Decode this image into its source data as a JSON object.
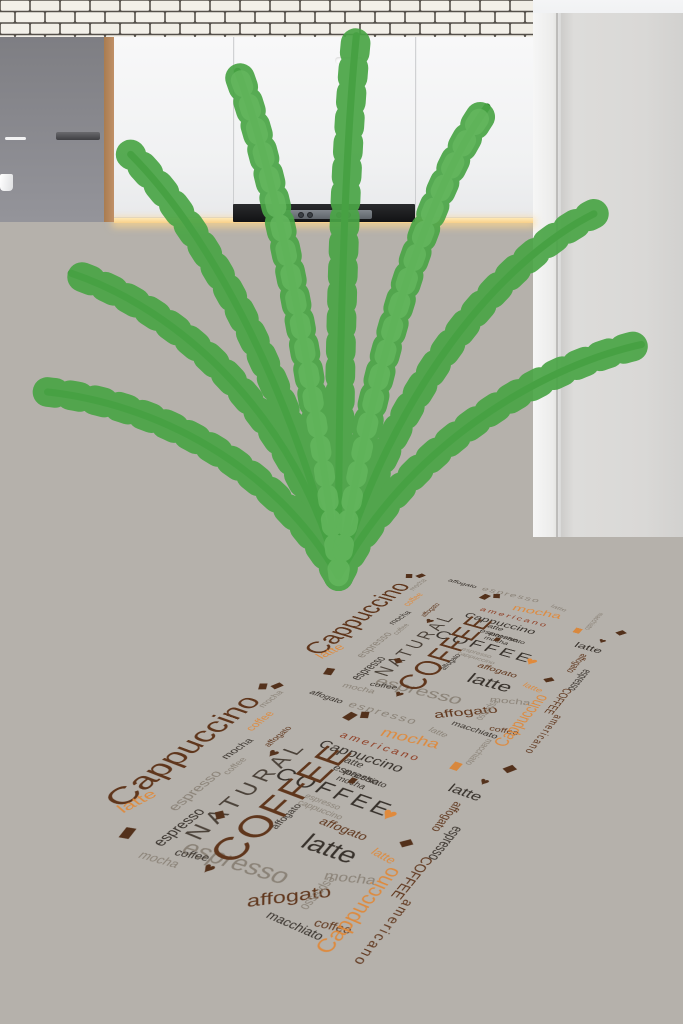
{
  "scene": {
    "palette": {
      "wall": "#e9ebee",
      "right_wall": "#d9d8d6",
      "cabinet": "#f0f1f2",
      "shelf_wood": "#bf8f66",
      "island_wood": "#7e5639",
      "tile": "#f3f0e9",
      "grout": "#4f4a45",
      "counter_marble": "#f1eee7",
      "oven_body": "#3c404a",
      "floor": "#b6b2ac",
      "under_cabinet_glow": "#ffd998",
      "plant_green": "#4aa546"
    }
  },
  "rug": {
    "width": 320,
    "height": 580,
    "tile_height": 290,
    "repeats": 2,
    "background": "#ebe4d6",
    "border_color": "#3a2313",
    "colors": {
      "brown": "#5f361c",
      "dark": "#37312b",
      "dark2": "#4a4138",
      "orange": "#dd8a3e",
      "maroon": "#8f3c22",
      "gray": "#8a8277",
      "bean": "#53311b",
      "bean_orange": "#d8883e",
      "heart_brown": "#54321c",
      "heart_orange": "#e08a3c"
    },
    "words": [
      {
        "t": "espresso",
        "x": 150,
        "y": 14,
        "s": 15,
        "r": -4,
        "c": "gray",
        "f": "serif caps outline",
        "ls": 2
      },
      {
        "t": "affogato",
        "x": 84,
        "y": 18,
        "s": 11,
        "r": 0,
        "c": "dark",
        "f": "sans bold"
      },
      {
        "t": "latte",
        "x": 215,
        "y": 16,
        "s": 11,
        "r": 6,
        "c": "gray",
        "f": "serif"
      },
      {
        "t": "macchiato",
        "x": 264,
        "y": 24,
        "s": 10,
        "r": 90,
        "c": "gray",
        "f": "sans"
      },
      {
        "t": "mocha",
        "x": 196,
        "y": 38,
        "s": 20,
        "r": -8,
        "c": "orange",
        "f": "script"
      },
      {
        "t": "americano",
        "x": 178,
        "y": 62,
        "s": 13,
        "r": -2,
        "c": "maroon",
        "f": "sans bold caps",
        "ls": 3
      },
      {
        "t": "Cappuccino",
        "x": 170,
        "y": 84,
        "s": 17,
        "r": -2,
        "c": "dark",
        "f": "script"
      },
      {
        "t": "latte espresso",
        "x": 182,
        "y": 102,
        "s": 12,
        "r": 0,
        "c": "dark",
        "f": "serif"
      },
      {
        "t": "macchiato mocha",
        "x": 192,
        "y": 116,
        "s": 10,
        "r": 0,
        "c": "dark",
        "f": "sans bold"
      },
      {
        "t": "COFFEE",
        "x": 178,
        "y": 140,
        "s": 24,
        "r": -1,
        "c": "dark",
        "f": "serif bold",
        "ls": 4
      },
      {
        "t": "espresso cappuccino",
        "x": 182,
        "y": 160,
        "s": 9,
        "r": 0,
        "c": "gray",
        "f": "sans"
      },
      {
        "t": "affogato",
        "x": 214,
        "y": 176,
        "s": 13,
        "r": 0,
        "c": "brown",
        "f": "script bold"
      },
      {
        "t": "latte",
        "x": 218,
        "y": 202,
        "s": 26,
        "r": -3,
        "c": "dark",
        "f": "serif bold"
      },
      {
        "t": "affogato",
        "x": 162,
        "y": 186,
        "s": 10,
        "r": -90,
        "c": "dark",
        "f": "sans"
      },
      {
        "t": "mocha",
        "x": 252,
        "y": 222,
        "s": 14,
        "r": -20,
        "c": "gray",
        "f": "script"
      },
      {
        "t": "espresso",
        "x": 160,
        "y": 252,
        "s": 24,
        "r": -6,
        "c": "gray",
        "f": "script"
      },
      {
        "t": "affogato",
        "x": 222,
        "y": 262,
        "s": 18,
        "r": -38,
        "c": "brown",
        "f": "script bold"
      },
      {
        "t": "macchiato",
        "x": 244,
        "y": 285,
        "s": 11,
        "r": 0,
        "c": "dark",
        "f": "sans bold"
      },
      {
        "t": "coffee",
        "x": 270,
        "y": 272,
        "s": 11,
        "r": -12,
        "c": "brown",
        "f": "serif"
      },
      {
        "t": "NATURAL",
        "x": 110,
        "y": 170,
        "s": 24,
        "r": -90,
        "c": "dark2",
        "f": "serif",
        "ls": 6
      },
      {
        "t": "COFFEE",
        "x": 148,
        "y": 168,
        "s": 40,
        "r": -90,
        "c": "brown",
        "f": "serif bold",
        "ls": 2
      },
      {
        "t": "Cappuccino",
        "x": 20,
        "y": 150,
        "s": 36,
        "r": -90,
        "c": "brown",
        "f": "script"
      },
      {
        "t": "coffee",
        "x": 52,
        "y": 84,
        "s": 13,
        "r": -90,
        "c": "orange",
        "f": "serif"
      },
      {
        "t": "mocha",
        "x": 38,
        "y": 48,
        "s": 11,
        "r": -90,
        "c": "gray",
        "f": "script"
      },
      {
        "t": "latte",
        "x": 36,
        "y": 232,
        "s": 18,
        "r": -75,
        "c": "orange",
        "f": "script"
      },
      {
        "t": "espresso",
        "x": 70,
        "y": 196,
        "s": 15,
        "r": -90,
        "c": "gray",
        "f": "serif"
      },
      {
        "t": "mocha",
        "x": 62,
        "y": 130,
        "s": 12,
        "r": -85,
        "c": "dark",
        "f": "script"
      },
      {
        "t": "affogato",
        "x": 84,
        "y": 96,
        "s": 10,
        "r": -90,
        "c": "brown",
        "f": "sans"
      },
      {
        "t": "espresso",
        "x": 92,
        "y": 240,
        "s": 16,
        "r": -88,
        "c": "dark",
        "f": "sans",
        "sx": 0.8
      },
      {
        "t": "coffee",
        "x": 78,
        "y": 152,
        "s": 10,
        "r": -90,
        "c": "gray",
        "f": "serif caps outline"
      },
      {
        "t": "latte",
        "x": 282,
        "y": 84,
        "s": 17,
        "r": 0,
        "c": "dark",
        "f": "serif bold"
      },
      {
        "t": "espresso",
        "x": 300,
        "y": 150,
        "s": 14,
        "r": 90,
        "c": "dark",
        "f": "sans",
        "sx": 0.8
      },
      {
        "t": "affogato",
        "x": 284,
        "y": 120,
        "s": 12,
        "r": 90,
        "c": "brown",
        "f": "sans bold"
      },
      {
        "t": "COFFEE",
        "x": 296,
        "y": 198,
        "s": 13,
        "r": 90,
        "c": "brown",
        "f": "serif bold"
      },
      {
        "t": "Cappuccino",
        "x": 278,
        "y": 246,
        "s": 19,
        "r": -90,
        "c": "orange",
        "f": "script"
      },
      {
        "t": "americano",
        "x": 307,
        "y": 258,
        "s": 12,
        "r": 90,
        "c": "brown",
        "f": "sans bold caps",
        "ls": 2
      },
      {
        "t": "latte",
        "x": 262,
        "y": 188,
        "s": 12,
        "r": 8,
        "c": "orange",
        "f": "script"
      },
      {
        "t": "espresso",
        "x": 240,
        "y": 248,
        "s": 12,
        "r": 90,
        "c": "gray",
        "f": "sans",
        "sx": 0.8
      },
      {
        "t": "coffee",
        "x": 124,
        "y": 262,
        "s": 11,
        "r": -14,
        "c": "dark",
        "f": "sans"
      },
      {
        "t": "mocha",
        "x": 104,
        "y": 278,
        "s": 12,
        "r": -8,
        "c": "gray",
        "f": "script"
      },
      {
        "type": "heart",
        "x": 96,
        "y": 120,
        "s": 12,
        "c": "heart_brown"
      },
      {
        "type": "heart",
        "x": 238,
        "y": 142,
        "s": 15,
        "c": "heart_orange"
      },
      {
        "type": "heart",
        "x": 146,
        "y": 268,
        "s": 11,
        "c": "heart_brown"
      },
      {
        "type": "heart",
        "x": 290,
        "y": 62,
        "s": 10,
        "c": "heart_brown"
      },
      {
        "type": "bean",
        "x": 16,
        "y": 34,
        "s": 8,
        "r": -30
      },
      {
        "type": "bean",
        "x": 28,
        "y": 26,
        "s": 8,
        "r": 20
      },
      {
        "type": "bean",
        "x": 124,
        "y": 34,
        "s": 9,
        "r": 10
      },
      {
        "type": "bean",
        "x": 136,
        "y": 26,
        "s": 8,
        "r": -25
      },
      {
        "type": "bean",
        "x": 256,
        "y": 54,
        "s": 8,
        "r": 0,
        "c": "bean_orange"
      },
      {
        "type": "bean",
        "x": 302,
        "y": 34,
        "s": 8,
        "r": 30
      },
      {
        "type": "bean",
        "x": 58,
        "y": 266,
        "s": 9,
        "r": -15
      },
      {
        "type": "bean",
        "x": 184,
        "y": 118,
        "s": 6,
        "r": 0
      },
      {
        "type": "bean",
        "x": 270,
        "y": 166,
        "s": 7,
        "r": 40
      },
      {
        "type": "bean",
        "x": 110,
        "y": 212,
        "s": 7,
        "r": -50
      }
    ]
  }
}
